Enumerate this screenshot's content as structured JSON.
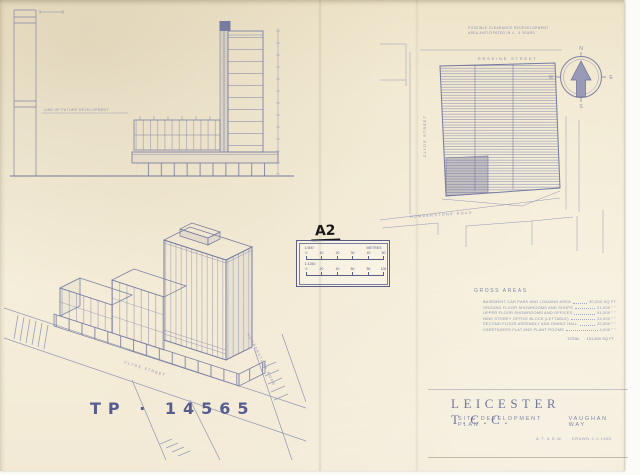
{
  "colors": {
    "paper": "#f3ebd5",
    "ink": "#8a8cab",
    "ink_dark": "#6f7299",
    "marker_black": "#17171c",
    "tp_blue": "#585c8e"
  },
  "document": {
    "tp_number": "TP · 14565",
    "sheet_ref_handwritten": "A2"
  },
  "elevation": {
    "note": "LINE OF FUTURE DEVELOPMENT"
  },
  "site_plan": {
    "note_line1": "POSSIBLE CLEARANCE REDEVELOPMENT",
    "note_line2": "AREA ANTICIPATED IN 4 - 5 YEARS",
    "streets": {
      "top": "ERSKINE STREET",
      "left": "CLYDE STREET",
      "bottom": "HUMBERSTONE ROAD"
    },
    "compass": {
      "n": "N",
      "e": "E",
      "s": "S",
      "w": "W"
    }
  },
  "axonometric": {
    "streets": {
      "front": "CLYDE STREET",
      "right": "HUMBERSTONE ROAD"
    }
  },
  "scale_box": {
    "handwritten_label": "A2",
    "bar1": {
      "scale": "1:500",
      "units": "METRES",
      "ticks": [
        "0",
        "10",
        "20",
        "30",
        "40",
        "50"
      ]
    },
    "bar2": {
      "scale": "1:1250",
      "ticks": [
        "0",
        "20",
        "40",
        "60",
        "80",
        "100"
      ]
    }
  },
  "gross_areas": {
    "heading": "GROSS AREAS",
    "rows": [
      {
        "label": "BASEMENT CAR PARK AND LOADING AREA",
        "value": "30,000 SQ FT"
      },
      {
        "label": "GROUND FLOOR SHOWROOMS AND SHOPS",
        "value": "21,000  \"  \""
      },
      {
        "label": "UPPER FLOOR SHOWROOMS AND OFFICES",
        "value": "51,000  \"  \""
      },
      {
        "label": "NINE STOREY OFFICE BLOCK (LETTABLE)",
        "value": "24,500  \"  \""
      },
      {
        "label": "SECOND FLOOR ASSEMBLY AND DINING HALL",
        "value": "20,500  \"  \""
      },
      {
        "label": "CARETAKERS FLAT AND PLANT ROOMS",
        "value": "4,500  \"  \""
      }
    ],
    "total_label": "TOTAL",
    "total_value": "151,500 SQ FT"
  },
  "title_block": {
    "title": "LEICESTER T.C.C.",
    "subtitle": "SITE DEVELOPMENT PLAN",
    "subtitle_suffix": "VAUGHAN WAY",
    "credit_left": "A.T. & E.W.",
    "credit_right": "DRAWN  2.1.1960"
  }
}
